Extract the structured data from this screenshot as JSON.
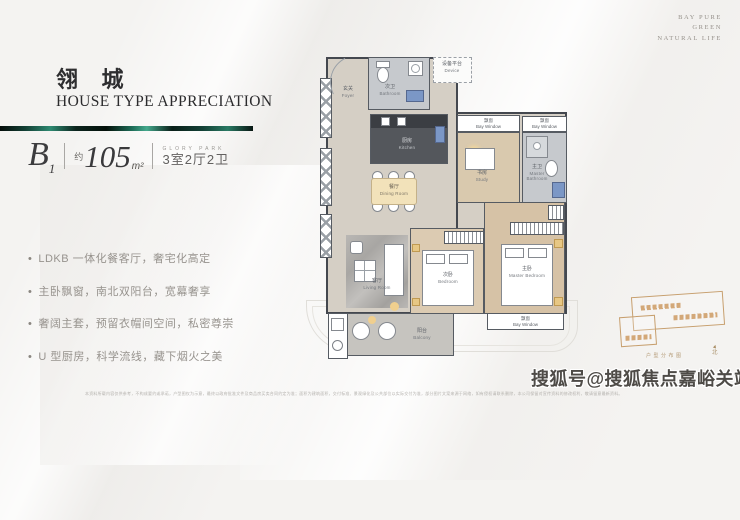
{
  "brand": {
    "lines": [
      "BAY PURE",
      "GREEN",
      "NATURAL LIFE"
    ]
  },
  "header": {
    "title": "翎 城",
    "subtitle": "HOUSE TYPE APPRECIATION"
  },
  "spec": {
    "series": "B",
    "series_sub": "1",
    "approx": "约",
    "area": "105",
    "unit": "m²",
    "collection": "GLORY PARK",
    "rooms": "3室2厅2卫"
  },
  "features": [
    "LDKB 一体化餐客厅，奢宅化高定",
    "主卧飘窗，南北双阳台，宽幕奢享",
    "奢阔主套，预留衣帽间空间，私密尊崇",
    "U 型厨房，科学流线，藏下烟火之美"
  ],
  "plan": {
    "rooms": {
      "foyer": {
        "cn": "玄关",
        "en": "Foyer"
      },
      "bath2": {
        "cn": "次卫",
        "en": "Bathroom"
      },
      "device": {
        "cn": "设备平台",
        "en": "Device"
      },
      "kitchen": {
        "cn": "厨房",
        "en": "Kitchen"
      },
      "dining": {
        "cn": "餐厅",
        "en": "Dining Room"
      },
      "study": {
        "cn": "书房",
        "en": "Study"
      },
      "master_bath": {
        "cn": "主卫",
        "en": "Master Bathroom"
      },
      "living": {
        "cn": "客厅",
        "en": "Living Room"
      },
      "bedroom2": {
        "cn": "次卧",
        "en": "Bedroom"
      },
      "master": {
        "cn": "主卧",
        "en": "Master Bedroom"
      },
      "balcony": {
        "cn": "阳台",
        "en": "Balcony"
      },
      "bay": {
        "cn": "飘窗",
        "en": "Bay Window"
      }
    }
  },
  "sitemap": {
    "caption": "户型分布图",
    "north": "北"
  },
  "footer": {
    "watermark": "搜狐号@搜狐焦点嘉峪关站",
    "disclaimer": "本资料所载内容仅供参考，不构成要约或承诺，户型图仅为示意，最终以政府批准文件及商品房买卖合同约定为准；面积为建筑面积，交付标准、景观绿化及公共部位以实际交付为准，部分图片文案来源于网络，如有侵权请联系删除，本公司保留对宣传资料的修改权利，敬请留意最新资料。"
  },
  "colors": {
    "accent_malachite": "#1d6b56",
    "wall": "#44484f",
    "floor_beige": "#d5cfc5",
    "floor_wood": "#d9c9ae",
    "fixture_blue": "#7b97c6",
    "accent_gold": "#e7c784"
  }
}
